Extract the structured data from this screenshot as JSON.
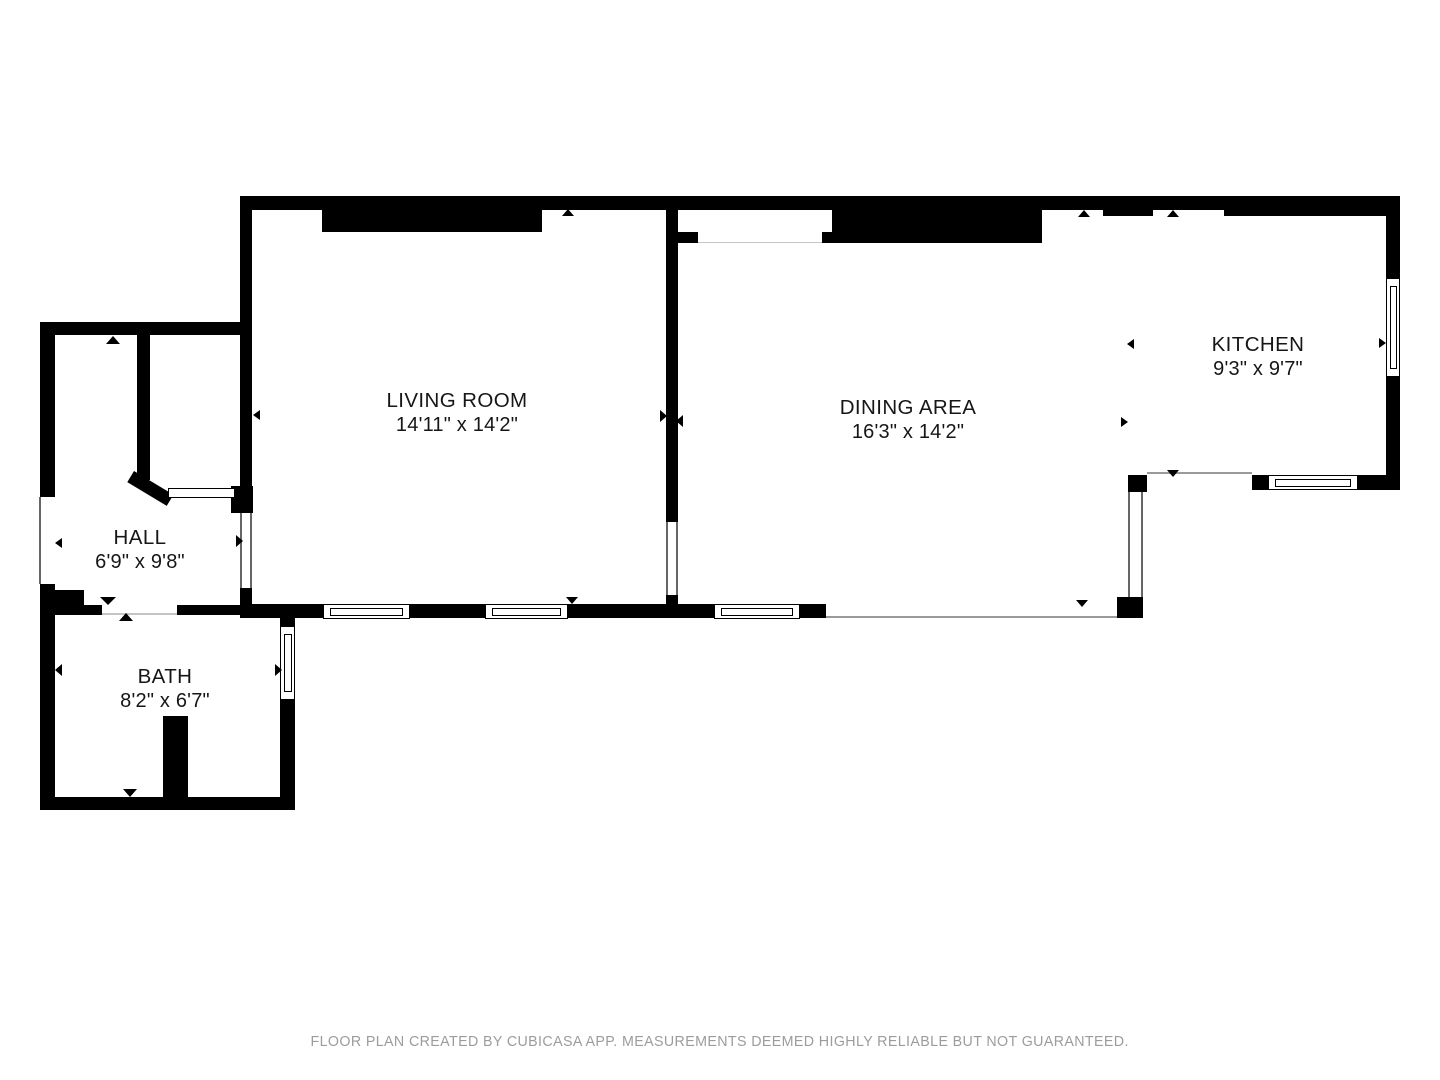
{
  "footer": {
    "text": "FLOOR PLAN CREATED BY CUBICASA APP. MEASUREMENTS DEEMED HIGHLY RELIABLE BUT NOT GUARANTEED."
  },
  "colors": {
    "wall": "#000000",
    "background": "#ffffff",
    "edge": "#666666",
    "open": "#9a9a9a",
    "faint": "#c4c4c4",
    "text": "#161616",
    "footer_text": "#9c9c9c"
  },
  "rooms": [
    {
      "id": "living-room",
      "name": "LIVING ROOM",
      "dims": "14'11\" x 14'2\"",
      "cx": 457,
      "cy": 413
    },
    {
      "id": "dining-area",
      "name": "DINING AREA",
      "dims": "16'3\" x 14'2\"",
      "cx": 908,
      "cy": 420
    },
    {
      "id": "kitchen",
      "name": "KITCHEN",
      "dims": "9'3\" x 9'7\"",
      "cx": 1258,
      "cy": 357
    },
    {
      "id": "hall",
      "name": "HALL",
      "dims": "6'9\" x 9'8\"",
      "cx": 140,
      "cy": 550
    },
    {
      "id": "bath",
      "name": "BATH",
      "dims": "8'2\" x 6'7\"",
      "cx": 165,
      "cy": 689
    }
  ],
  "geometry": {
    "walls": [
      {
        "x": 240,
        "y": 196,
        "w": 1160,
        "h": 14
      },
      {
        "x": 240,
        "y": 210,
        "w": 12,
        "h": 303
      },
      {
        "x": 231,
        "y": 486,
        "w": 22,
        "h": 27
      },
      {
        "x": 322,
        "y": 210,
        "w": 220,
        "h": 22
      },
      {
        "x": 666,
        "y": 210,
        "w": 12,
        "h": 312
      },
      {
        "x": 666,
        "y": 595,
        "w": 12,
        "h": 9
      },
      {
        "x": 677,
        "y": 232,
        "w": 21,
        "h": 11
      },
      {
        "x": 822,
        "y": 232,
        "w": 10,
        "h": 11
      },
      {
        "x": 832,
        "y": 210,
        "w": 210,
        "h": 33
      },
      {
        "x": 1103,
        "y": 210,
        "w": 50,
        "h": 6
      },
      {
        "x": 1224,
        "y": 210,
        "w": 162,
        "h": 6
      },
      {
        "x": 1386,
        "y": 210,
        "w": 14,
        "h": 68
      },
      {
        "x": 1386,
        "y": 377,
        "w": 14,
        "h": 113
      },
      {
        "x": 1252,
        "y": 475,
        "w": 16,
        "h": 15
      },
      {
        "x": 1358,
        "y": 475,
        "w": 42,
        "h": 15
      },
      {
        "x": 1128,
        "y": 475,
        "w": 19,
        "h": 17
      },
      {
        "x": 1117,
        "y": 597,
        "w": 26,
        "h": 21
      },
      {
        "x": 240,
        "y": 588,
        "w": 12,
        "h": 16
      },
      {
        "x": 240,
        "y": 604,
        "w": 83,
        "h": 14
      },
      {
        "x": 410,
        "y": 604,
        "w": 75,
        "h": 14
      },
      {
        "x": 568,
        "y": 604,
        "w": 146,
        "h": 14
      },
      {
        "x": 800,
        "y": 604,
        "w": 26,
        "h": 14
      },
      {
        "x": 55,
        "y": 605,
        "w": 47,
        "h": 10
      },
      {
        "x": 177,
        "y": 605,
        "w": 63,
        "h": 10
      },
      {
        "x": 55,
        "y": 590,
        "w": 29,
        "h": 15
      },
      {
        "x": 40,
        "y": 322,
        "w": 15,
        "h": 175
      },
      {
        "x": 40,
        "y": 584,
        "w": 15,
        "h": 226
      },
      {
        "x": 40,
        "y": 322,
        "w": 212,
        "h": 13
      },
      {
        "x": 137,
        "y": 335,
        "w": 13,
        "h": 145
      },
      {
        "x": 280,
        "y": 613,
        "w": 15,
        "h": 14
      },
      {
        "x": 280,
        "y": 699,
        "w": 15,
        "h": 111
      },
      {
        "x": 40,
        "y": 797,
        "w": 255,
        "h": 13
      },
      {
        "x": 163,
        "y": 716,
        "w": 25,
        "h": 81
      }
    ],
    "diagonals": [
      {
        "x": 134,
        "y": 471,
        "w": 46,
        "h": 13,
        "rot": 31
      }
    ],
    "doors": [
      {
        "x": 168,
        "y": 488,
        "w": 67,
        "h": 10
      }
    ],
    "windows": [
      {
        "x": 323,
        "y": 604,
        "w": 87,
        "h": 15,
        "o": "h"
      },
      {
        "x": 485,
        "y": 604,
        "w": 83,
        "h": 15,
        "o": "h"
      },
      {
        "x": 714,
        "y": 604,
        "w": 86,
        "h": 15,
        "o": "h"
      },
      {
        "x": 1268,
        "y": 475,
        "w": 90,
        "h": 15,
        "o": "h"
      },
      {
        "x": 280,
        "y": 626,
        "w": 15,
        "h": 74,
        "o": "v"
      },
      {
        "x": 1386,
        "y": 278,
        "w": 14,
        "h": 99,
        "o": "v"
      }
    ],
    "lines": [
      {
        "x": 39,
        "y": 497,
        "w": 2,
        "h": 87,
        "c": "edge"
      },
      {
        "x": 240,
        "y": 513,
        "w": 2,
        "h": 75,
        "c": "edge"
      },
      {
        "x": 250,
        "y": 513,
        "w": 2,
        "h": 75,
        "c": "edge"
      },
      {
        "x": 666,
        "y": 522,
        "w": 2,
        "h": 73,
        "c": "edge"
      },
      {
        "x": 676,
        "y": 522,
        "w": 2,
        "h": 73,
        "c": "edge"
      },
      {
        "x": 1128,
        "y": 492,
        "w": 2,
        "h": 105,
        "c": "edge"
      },
      {
        "x": 1141,
        "y": 492,
        "w": 2,
        "h": 105,
        "c": "edge"
      },
      {
        "x": 1147,
        "y": 472,
        "w": 105,
        "h": 2,
        "c": "open"
      },
      {
        "x": 826,
        "y": 616,
        "w": 291,
        "h": 2,
        "c": "open"
      },
      {
        "x": 698,
        "y": 241.5,
        "w": 124,
        "h": 1.5,
        "c": "faint"
      },
      {
        "x": 102,
        "y": 613,
        "w": 75,
        "h": 1.5,
        "c": "faint"
      }
    ],
    "arrows": [
      {
        "x": 106,
        "y": 336,
        "w": 14,
        "h": 8,
        "dir": "up"
      },
      {
        "x": 55,
        "y": 538,
        "w": 7,
        "h": 11,
        "dir": "left"
      },
      {
        "x": 236,
        "y": 535,
        "w": 7,
        "h": 12,
        "dir": "right"
      },
      {
        "x": 100,
        "y": 597,
        "w": 16,
        "h": 8,
        "dir": "down"
      },
      {
        "x": 119,
        "y": 613,
        "w": 14,
        "h": 8,
        "dir": "up"
      },
      {
        "x": 55,
        "y": 664,
        "w": 7,
        "h": 12,
        "dir": "left"
      },
      {
        "x": 275,
        "y": 664,
        "w": 7,
        "h": 12,
        "dir": "right"
      },
      {
        "x": 123,
        "y": 789,
        "w": 14,
        "h": 8,
        "dir": "down"
      },
      {
        "x": 253,
        "y": 410,
        "w": 7,
        "h": 11,
        "dir": "left"
      },
      {
        "x": 562,
        "y": 209,
        "w": 13,
        "h": 7,
        "dir": "up"
      },
      {
        "x": 566,
        "y": 597,
        "w": 13,
        "h": 7,
        "dir": "down"
      },
      {
        "x": 660,
        "y": 410,
        "w": 7,
        "h": 12,
        "dir": "right"
      },
      {
        "x": 676,
        "y": 415,
        "w": 7,
        "h": 12,
        "dir": "left"
      },
      {
        "x": 1127,
        "y": 339,
        "w": 7,
        "h": 11,
        "dir": "left"
      },
      {
        "x": 1121,
        "y": 417,
        "w": 7,
        "h": 11,
        "dir": "right"
      },
      {
        "x": 1379,
        "y": 338,
        "w": 7,
        "h": 11,
        "dir": "right"
      },
      {
        "x": 1167,
        "y": 470,
        "w": 13,
        "h": 7,
        "dir": "down"
      },
      {
        "x": 1076,
        "y": 600,
        "w": 13,
        "h": 7,
        "dir": "down"
      },
      {
        "x": 1078,
        "y": 210,
        "w": 13,
        "h": 7,
        "dir": "up"
      },
      {
        "x": 1167,
        "y": 210,
        "w": 13,
        "h": 7,
        "dir": "up"
      }
    ]
  }
}
